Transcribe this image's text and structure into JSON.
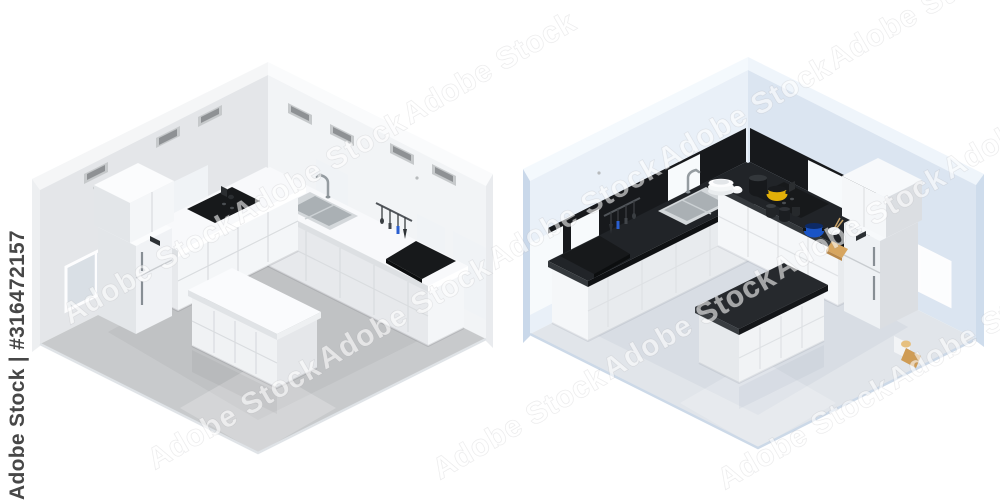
{
  "watermarks": {
    "side_label": "Adobe Stock | #316472157",
    "diagonal_label": "Adobe Stock"
  },
  "palette": {
    "room_left": {
      "wallL": "#e4e6e9",
      "wallR": "#f2f4f6",
      "wallTopL": "#f5f6f7",
      "wallTopR": "#fafbfc",
      "wallOuterL": "#edeff1",
      "wallOuterR": "#e9ebee",
      "floor": "#c8cacc",
      "flooredge": "#dfe3e7",
      "glassL": "#d9dfe5",
      "glassR": "#f0f3f6",
      "backsplash": "transparent",
      "vent": "#c6c9cb",
      "ventSlot": "#8e9194",
      "countertop": "#f8f9fb",
      "ctEdgeU": "#ffffff",
      "ctEdgeV": "#dde0e3",
      "cabFaceU": "#f4f6f8",
      "cabFaceV": "#e7e9ec",
      "fridgeFront": "#f0f2f5",
      "fridgeSide": "#e3e6e9",
      "fridgeTop": "#fbfcfd",
      "islandTop": "#fafbfd",
      "islandEdgeU": "#eef0f2",
      "islandEdgeV": "#e0e3e6",
      "islandFront": "#f0f2f4",
      "islandEnd": "#e5e7ea",
      "seam": "#d9dcdf",
      "reflect": "rgba(60,64,68,0.06)",
      "shadow": "rgba(40,44,48,0.12)"
    },
    "room_right": {
      "wallL": "#dbe5f1",
      "wallR": "#e9f0f8",
      "wallTopL": "#eff5fb",
      "wallTopR": "#f4f9fd",
      "wallOuterL": "#cedcec",
      "wallOuterR": "#c9d8ea",
      "floor": "#e1e5ea",
      "flooredge": "#ccd9e8",
      "glassL": "#fcfdfe",
      "glassR": "#f7fafc",
      "backsplash": "#17191c",
      "vent": "transparent",
      "ventSlot": "transparent",
      "countertop": "#212428",
      "ctEdgeU": "#34383c",
      "ctEdgeV": "#0f1113",
      "cabFaceU": "#f5f7f9",
      "cabFaceV": "#e8ebee",
      "fridgeFront": "#eef1f4",
      "fridgeSide": "#dbdee2",
      "fridgeTop": "#f7f9fb",
      "islandTop": "#26292d",
      "islandEdgeU": "#393d41",
      "islandEdgeV": "#141619",
      "islandFront": "#f1f3f5",
      "islandEnd": "#e6e9ec",
      "seam": "#dee1e4",
      "reflect": "rgba(90,110,130,0.06)",
      "shadow": "rgba(60,70,85,0.10)"
    }
  },
  "cookware_colors": {
    "yellow_pot": "#e2af08",
    "blue_pot": "#1a54c6",
    "orange_bowl": "#c06a14",
    "cutting_board": "#d7a660",
    "black_pot": "#17191c"
  }
}
